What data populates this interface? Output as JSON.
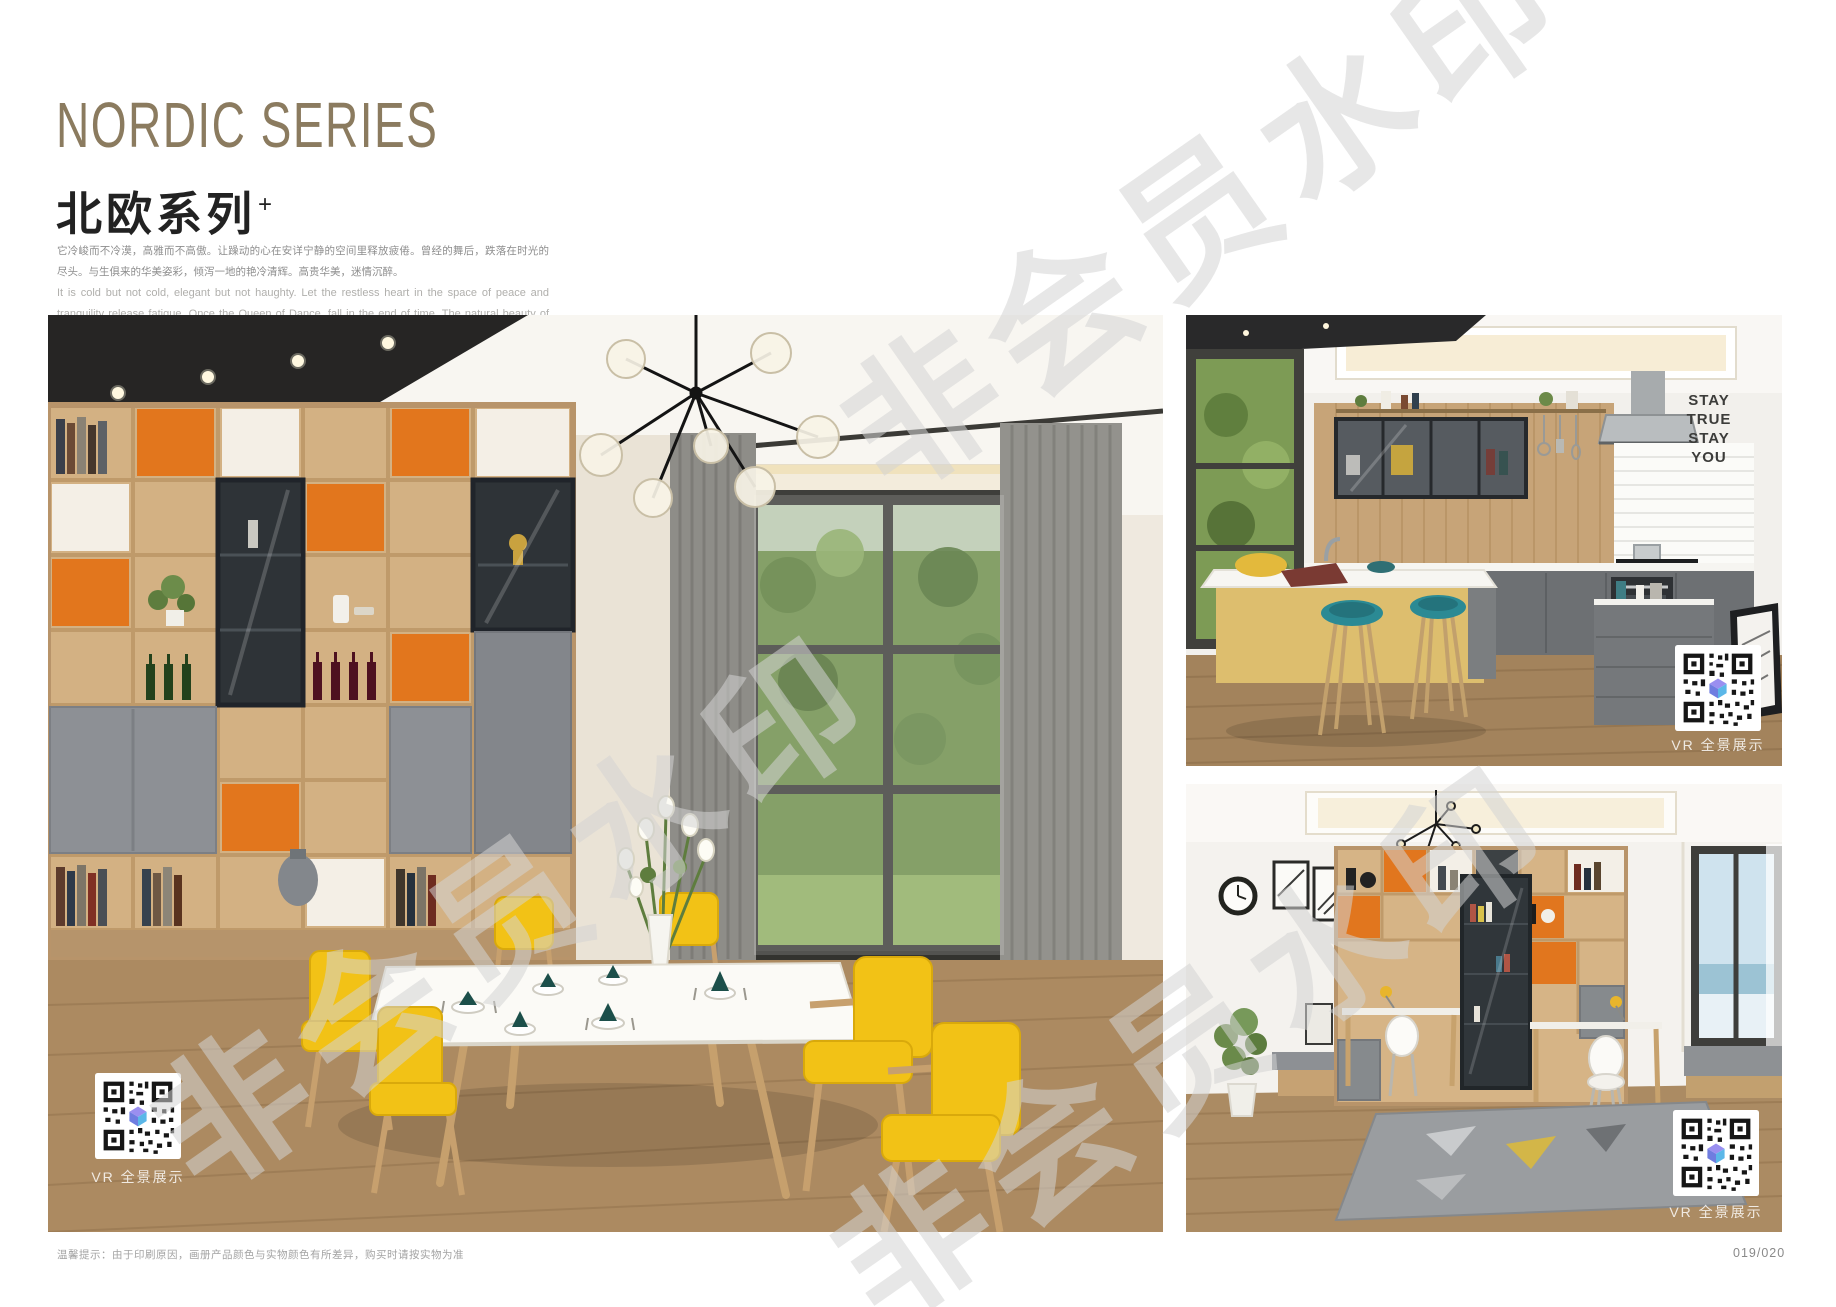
{
  "header": {
    "title_en": "NORDIC SERIES",
    "title_cn": "北欧系列",
    "title_superscript": "+",
    "intro_cn": "它冷峻而不冷漠，高雅而不高傲。让躁动的心在安详宁静的空间里释放疲倦。曾经的舞后，跌落在时光的尽头。与生俱来的华美姿彩，倾泻一地的艳冷清辉。高贵华美，迷情沉醉。",
    "intro_en": "It is cold but not cold, elegant but not haughty. Let the restless heart in the space of peace and tranquility release fatigue. Once the Queen of Dance, fall in the end of time. The natural beauty of the beautiful, pouring a land of cold and pure brilliance. Noble, beautiful, enchanted."
  },
  "watermark": {
    "text": "非会员水印"
  },
  "photos": {
    "dining_room": {
      "vr_label": "VR 全景展示"
    },
    "kitchen": {
      "vr_label": "VR 全景展示",
      "wall_art_lines": [
        "STAY",
        "TRUE",
        "STAY",
        "YOU"
      ]
    },
    "study": {
      "vr_label": "VR 全景展示"
    }
  },
  "footer": {
    "note": "温馨提示：由于印刷原因，画册产品颜色与实物颜色有所差异，购买时请按实物为准",
    "page_number": "019/020"
  },
  "colors": {
    "title_accent": "#8b7b5f",
    "body_text": "#8e8e8e",
    "english_text": "#b0afac",
    "watermark": "#d4d4d4",
    "chair_yellow": "#f2c216",
    "cabinet_orange": "#e2761d",
    "stool_teal": "#2b8a94"
  }
}
